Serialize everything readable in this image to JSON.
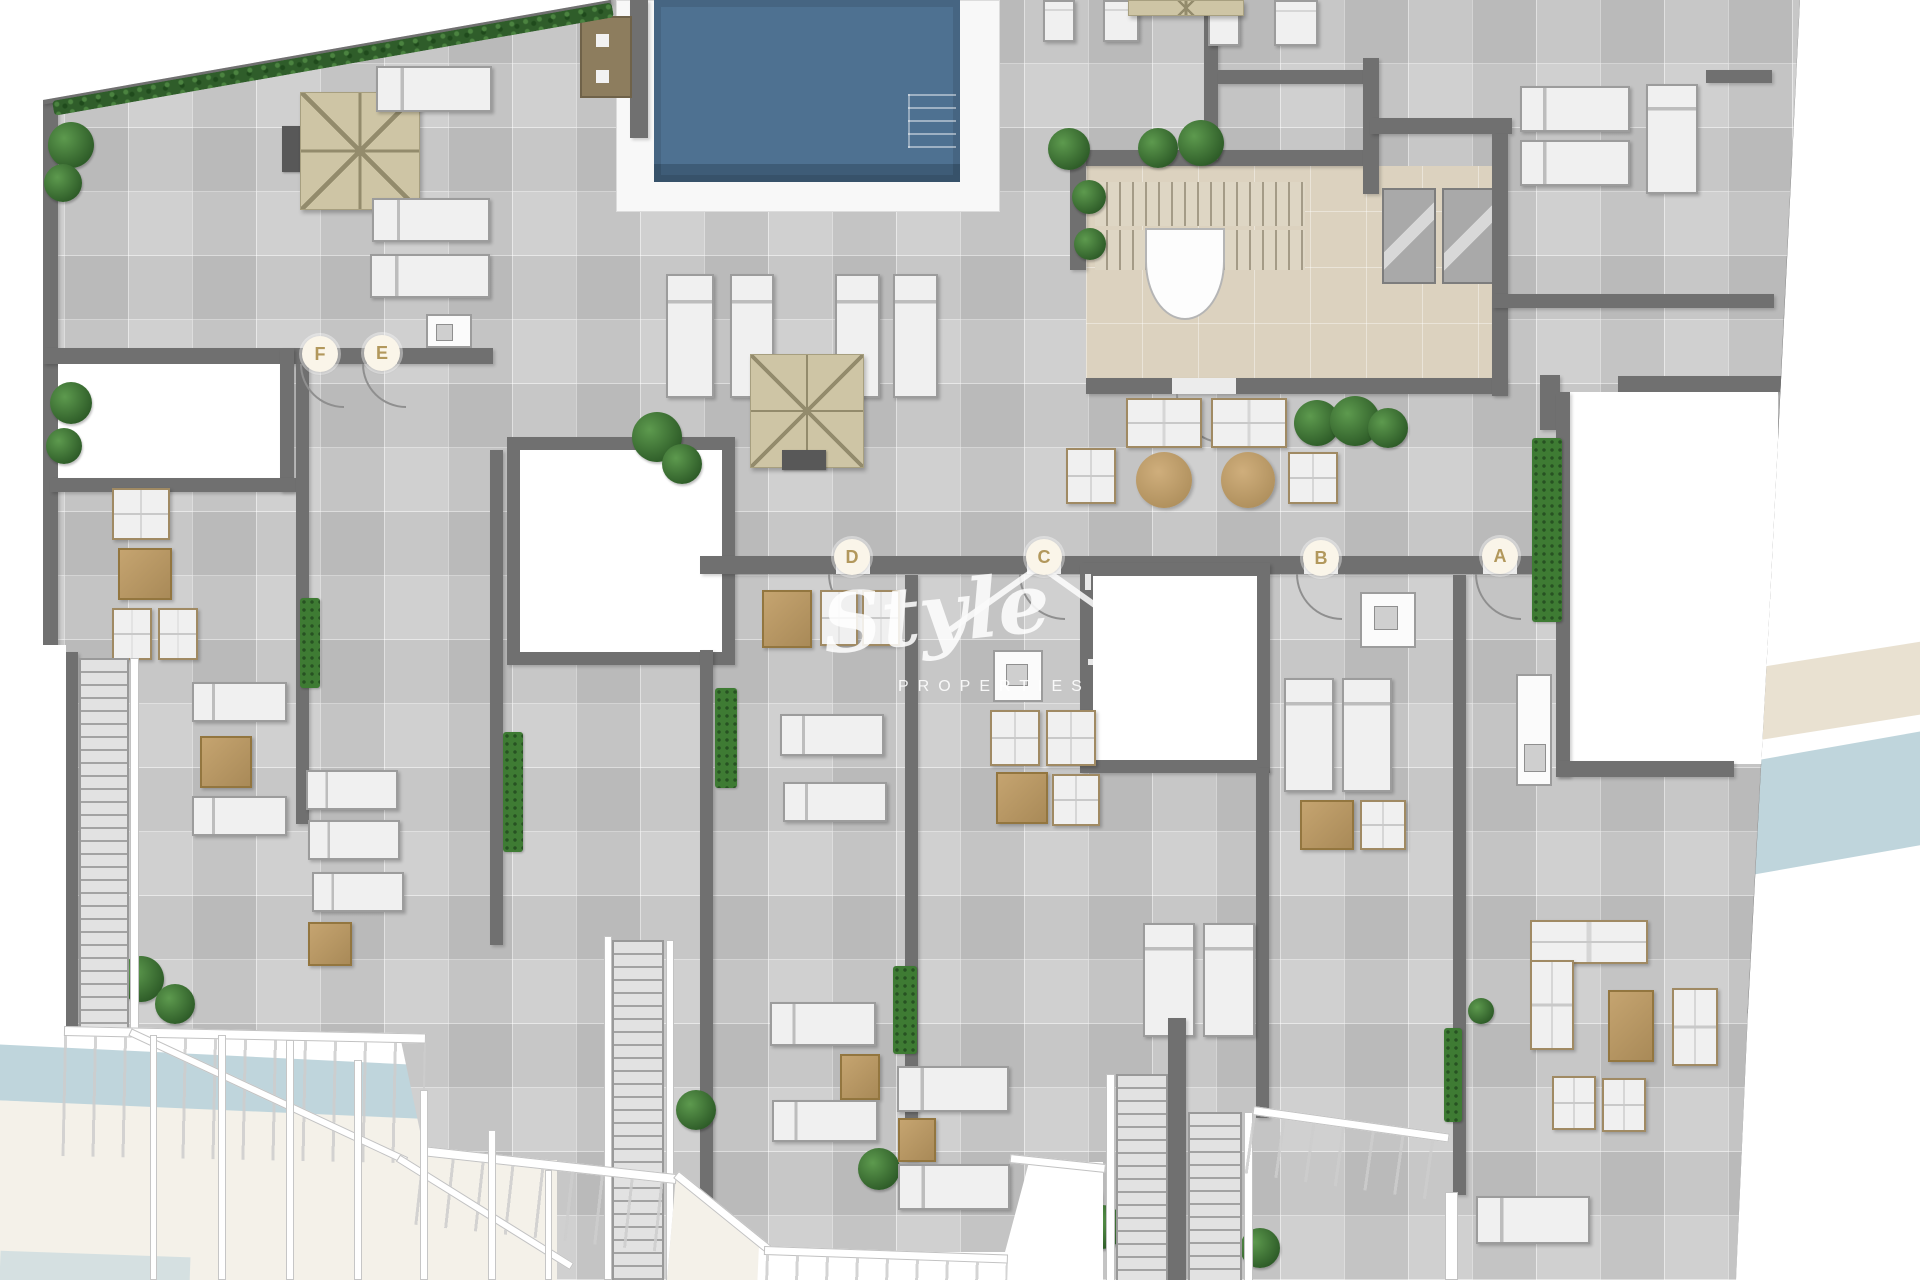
{
  "plan": {
    "title_hidden": "",
    "unit_labels": [
      {
        "label": "F",
        "x": 320,
        "y": 354
      },
      {
        "label": "E",
        "x": 382,
        "y": 353
      },
      {
        "label": "D",
        "x": 852,
        "y": 557
      },
      {
        "label": "C",
        "x": 1044,
        "y": 557
      },
      {
        "label": "B",
        "x": 1321,
        "y": 558
      },
      {
        "label": "A",
        "x": 1500,
        "y": 556
      }
    ]
  },
  "watermark": {
    "brand": "Style",
    "subtitle": "PROPERTIES",
    "icon": "house-outline-icon"
  },
  "colors": {
    "floor": "#c7c7c7",
    "wall": "#707070",
    "pool": "#4e7191",
    "pool_dark": "#3e5c77",
    "deck": "#f8f8f8",
    "core_floor": "#dcd2bf",
    "parasol": "#cec5a5",
    "parasol_line": "#938b6c",
    "lounger": "#f0f0f0",
    "lounger_border": "#9c9c9c",
    "plant": "#3e7b33",
    "hedge": "#2f5d2a",
    "label_bg": "#faf5e9",
    "label_text": "#b2985c",
    "swoosh_blue": "#bfd5dc",
    "swoosh_beige": "#e9e1d1",
    "cream": "#f4f1e9"
  }
}
